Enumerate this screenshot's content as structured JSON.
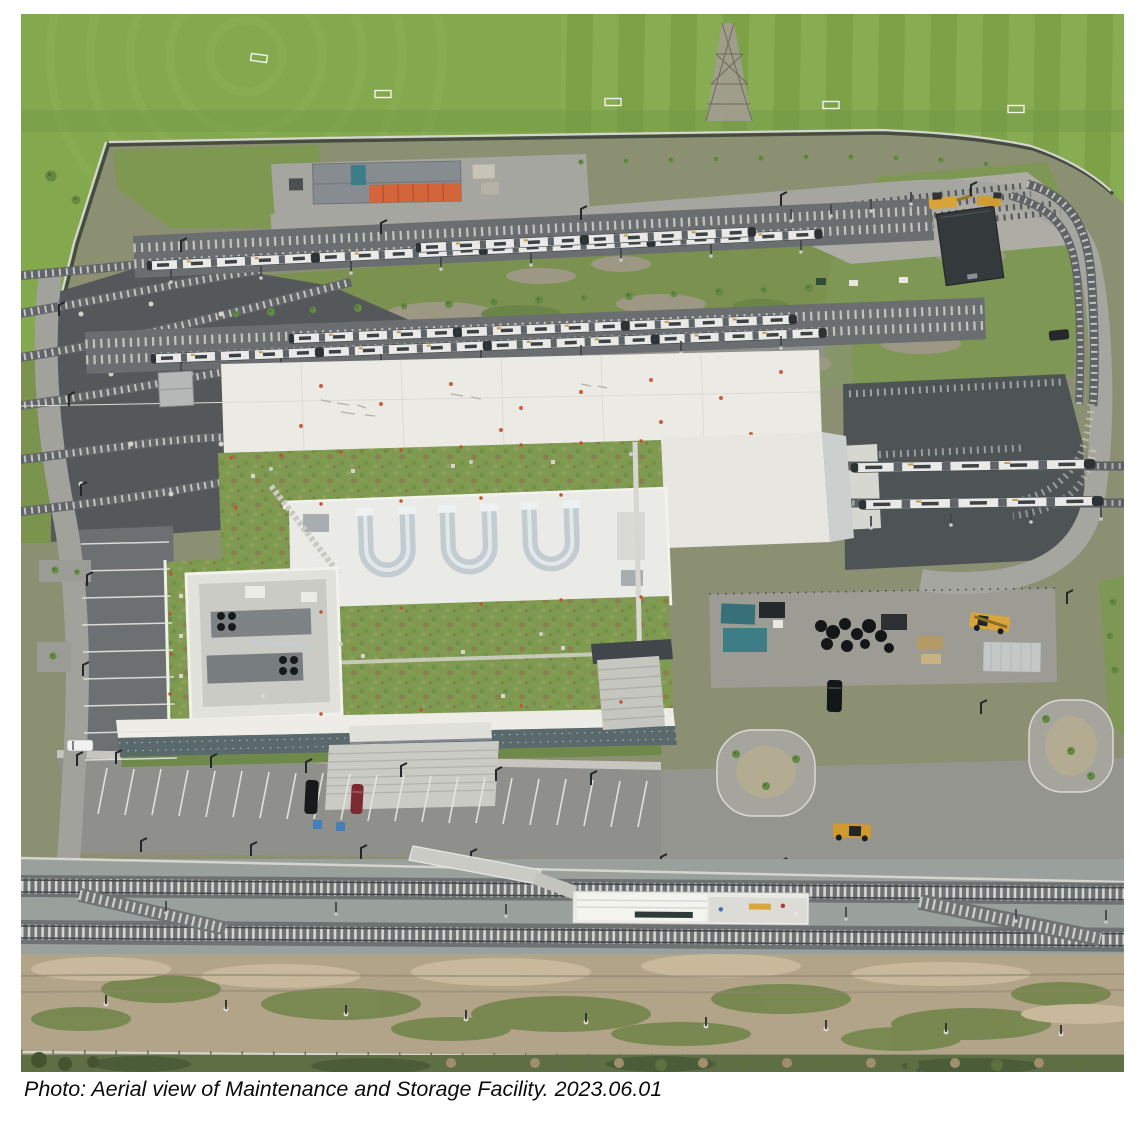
{
  "page": {
    "caption": "Photo: Aerial view of Maintenance and Storage Facility. 2023.06.01"
  },
  "photo": {
    "description": "Aerial drone view of a light rail Maintenance and Storage Facility: mowed grass sports fields and a steel lattice transmission tower at top; a fenced yard with rows of parked light rail vehicles, a gray storage shed with orange containers and a dark substation building; a large maintenance building with an extensive green roof, white membrane roof and three U-shaped rooftop ventilation ducts; an equipment yard with teal compressors, stacked tires and a yellow telehandler; striped staff parking with a few cars; a twin-track mainline with an island station platform in the foreground; and a sandy disturbed soil strip along the bottom.",
    "date_label": "2023.06.01",
    "elements": {
      "sports_fields": "mowed grass soccer fields with goals",
      "transmission_tower": "steel lattice transmission tower",
      "perimeter_fence": "security fence and wall around the yard",
      "storage_shed": "gray canopy shed with orange containers",
      "tram_rows": "rows of parked light rail vehicles",
      "substation": "dark electrical substation building",
      "yard_tracks": "curved yard lead tracks and loop track",
      "main_building": "maintenance and storage building with green roof",
      "hvac_ducts": "three U-shaped rooftop ventilation ducts",
      "equipment_yard": "compressors, tires, crates and machinery",
      "parking_lots": "striped parking lots with cars",
      "mainline_tracks": "double-track light rail mainline with crossovers",
      "station_platform": "white island station platform",
      "dirt_strip": "sandy disturbed ground strip with patchy weeds"
    },
    "palette": {
      "field_green": "#83a84d",
      "yard_grass": "#7e9751",
      "green_roof": "#7e9b51",
      "white_roof": "#ebeae5",
      "asphalt_light": "#a4a49f",
      "asphalt_dark": "#53575a",
      "ballast_gray": "#9aa09c",
      "sand_tan": "#b2a489",
      "container_orange": "#d2653a",
      "equipment_teal": "#3d7d85",
      "machine_yellow": "#d8a43c",
      "caption_text": "#0b0b0c"
    }
  }
}
